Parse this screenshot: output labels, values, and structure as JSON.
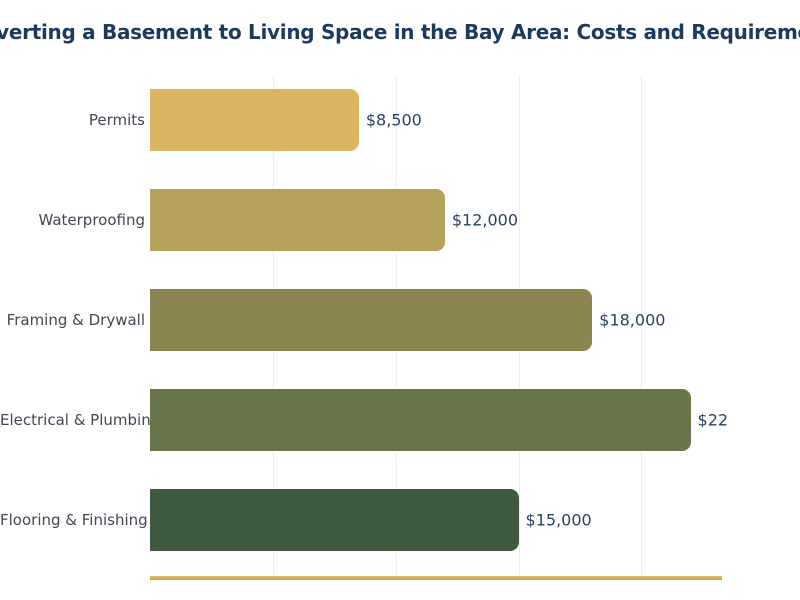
{
  "title": "Converting a Basement to Living Space in the Bay Area: Costs and Requirements",
  "colors": {
    "title": "#1c3a5e",
    "category_label": "#414753",
    "value_label": "#2b4263",
    "gridline": "#ededf2",
    "axis_line": "#cea146",
    "background": "#ffffff"
  },
  "chart_data": {
    "type": "bar",
    "orientation": "horizontal",
    "title": "Converting a Basement to Living Space in the Bay Area: Costs and Requirements",
    "xlabel": "",
    "ylabel": "",
    "categories": [
      "Permits",
      "Waterproofing",
      "Framing & Drywall",
      "Electrical & Plumbing",
      "Flooring & Finishing"
    ],
    "values": [
      8500,
      12000,
      18000,
      22000,
      15000
    ],
    "value_labels_displayed": [
      "$8,500",
      "$12,000",
      "$18,000",
      "$22",
      "$15,000"
    ],
    "bar_colors": [
      "#dcb562",
      "#b5a159",
      "#8c854f",
      "#687549",
      "#405a40"
    ],
    "xlim": [
      0,
      23280
    ],
    "gridline_values": [
      5000,
      10000,
      15000,
      20000
    ],
    "grid": true,
    "legend": false
  }
}
